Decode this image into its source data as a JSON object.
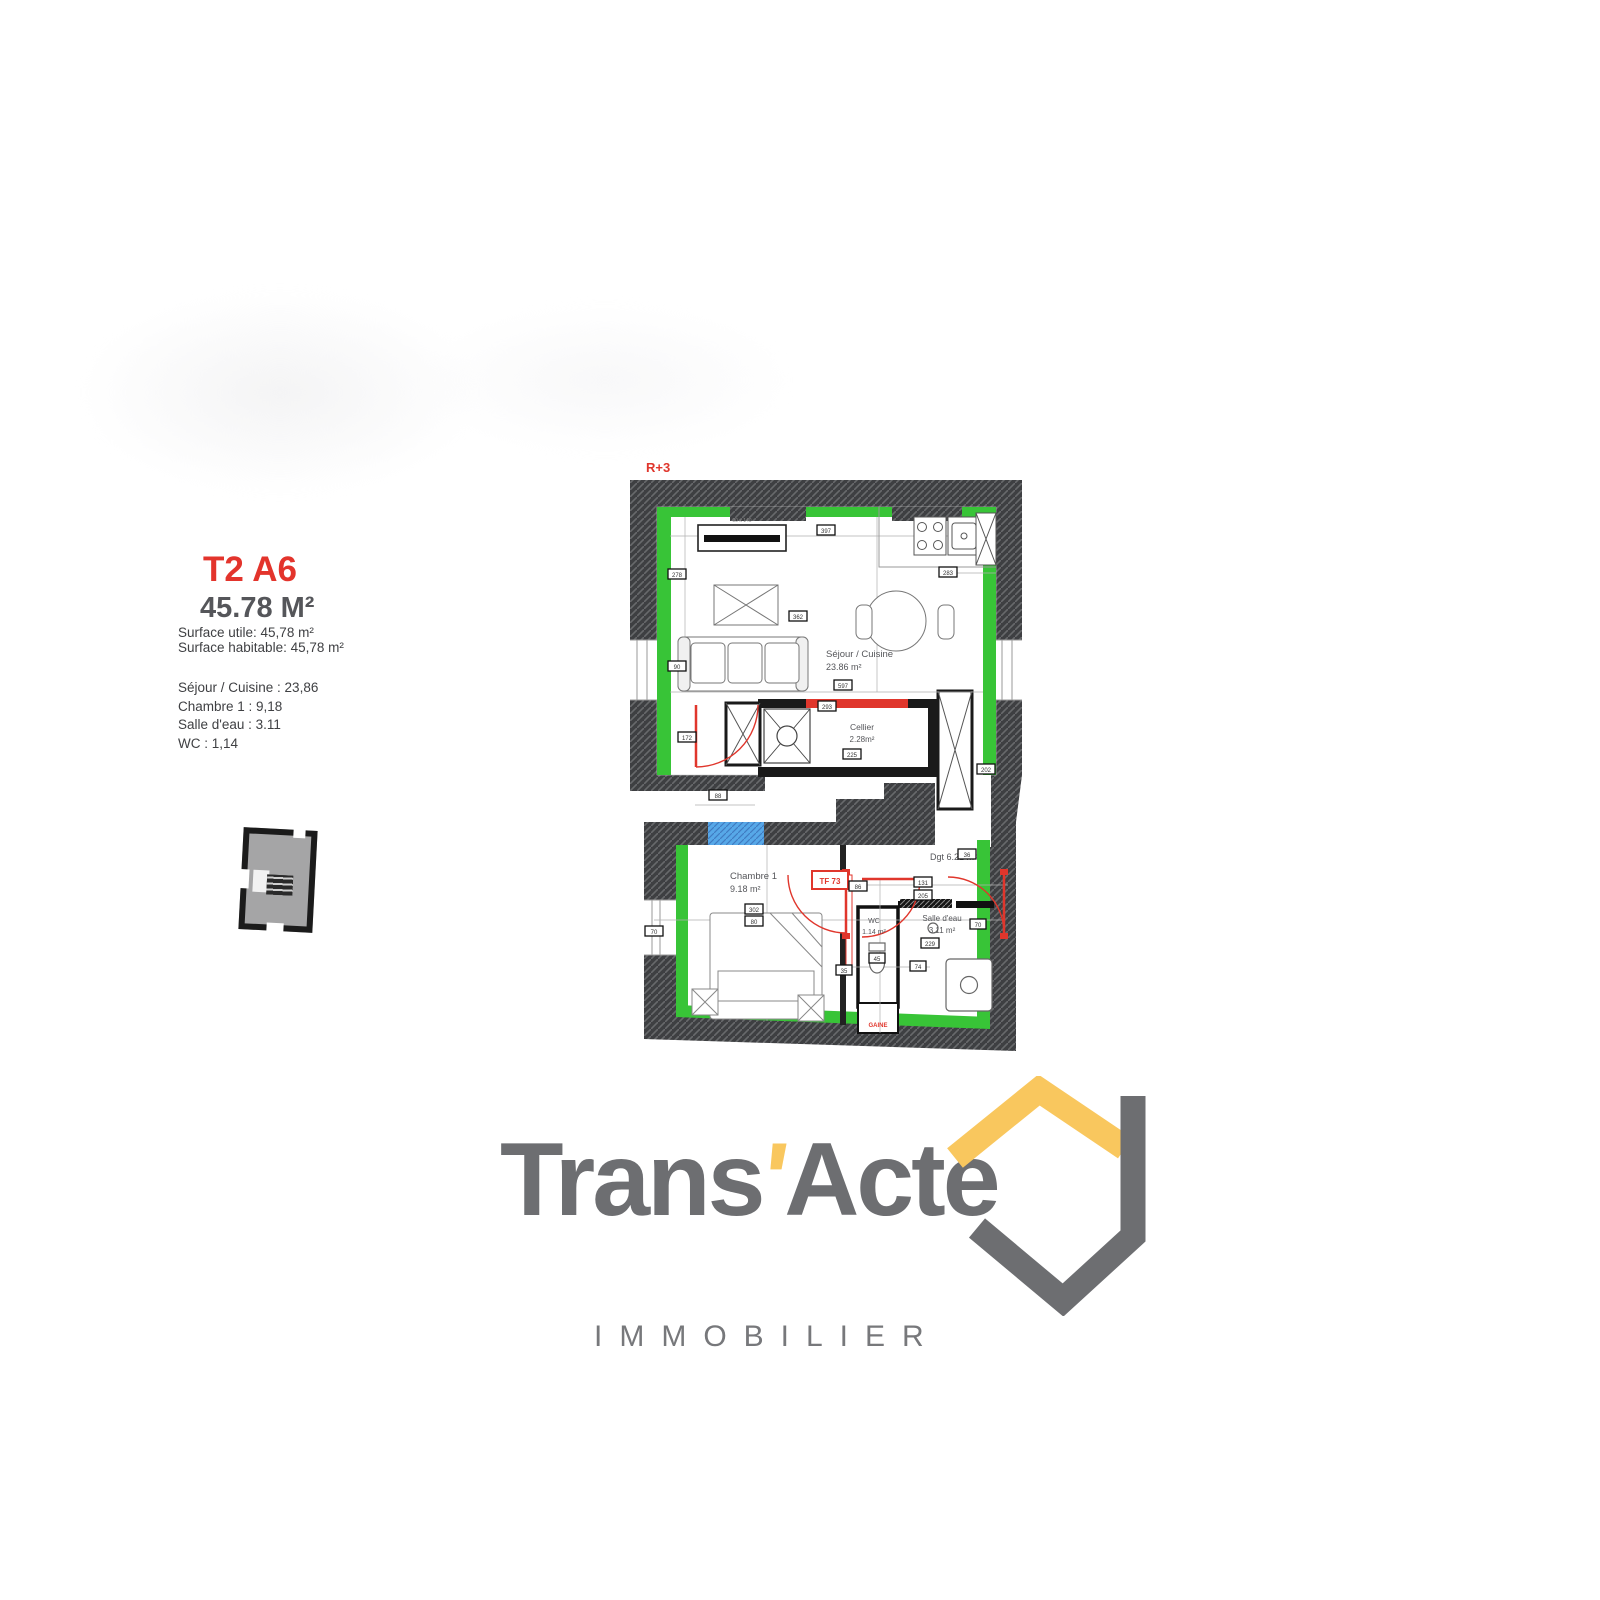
{
  "info_panel": {
    "unit_title": "T2 A6",
    "unit_area": "45.78 M²",
    "surface_utile": "Surface utile: 45,78 m²",
    "surface_habitable": "Surface habitable: 45,78 m²",
    "rooms": [
      "Séjour / Cuisine : 23,86",
      "Chambre 1 : 9,18",
      "Salle d'eau : 3.11",
      "WC : 1,14"
    ]
  },
  "floor_plan": {
    "level_label": "R+3",
    "sejour": {
      "name": "Séjour / Cuisine",
      "area": "23.86 m²"
    },
    "cellier": {
      "name": "Cellier",
      "area": "2.28m²"
    },
    "chambre": {
      "name": "Chambre 1",
      "area": "9.18 m²"
    },
    "dgt": {
      "name": "Dgt",
      "area": "6.21 m²"
    },
    "wc": {
      "name": "WC",
      "area": "1.14 m²"
    },
    "salle_eau": {
      "name": "Salle d'eau",
      "area": "3.11 m²"
    },
    "annotations": {
      "window_label": "TF 73",
      "duct_label": "GAINE",
      "radiator_label": "90 x 140"
    },
    "dimensions": [
      "397",
      "283",
      "278",
      "362",
      "90",
      "597",
      "293",
      "225",
      "202",
      "88",
      "172",
      "36",
      "302",
      "80",
      "131",
      "205",
      "86",
      "70",
      "45",
      "74",
      "229",
      "70",
      "35"
    ],
    "colors": {
      "wall": "#3e3f42",
      "insulation_green": "#38c437",
      "new_wall_red": "#e0362c",
      "window_blue": "#57a8e8",
      "interior_wall": "#1a1a1a"
    }
  },
  "logo": {
    "brand_prefix": "Trans",
    "apostrophe": "'",
    "brand_suffix": "Acte",
    "subtitle": "IMMOBILIER",
    "gray": "#6d6e71",
    "yellow": "#f9c75e"
  }
}
